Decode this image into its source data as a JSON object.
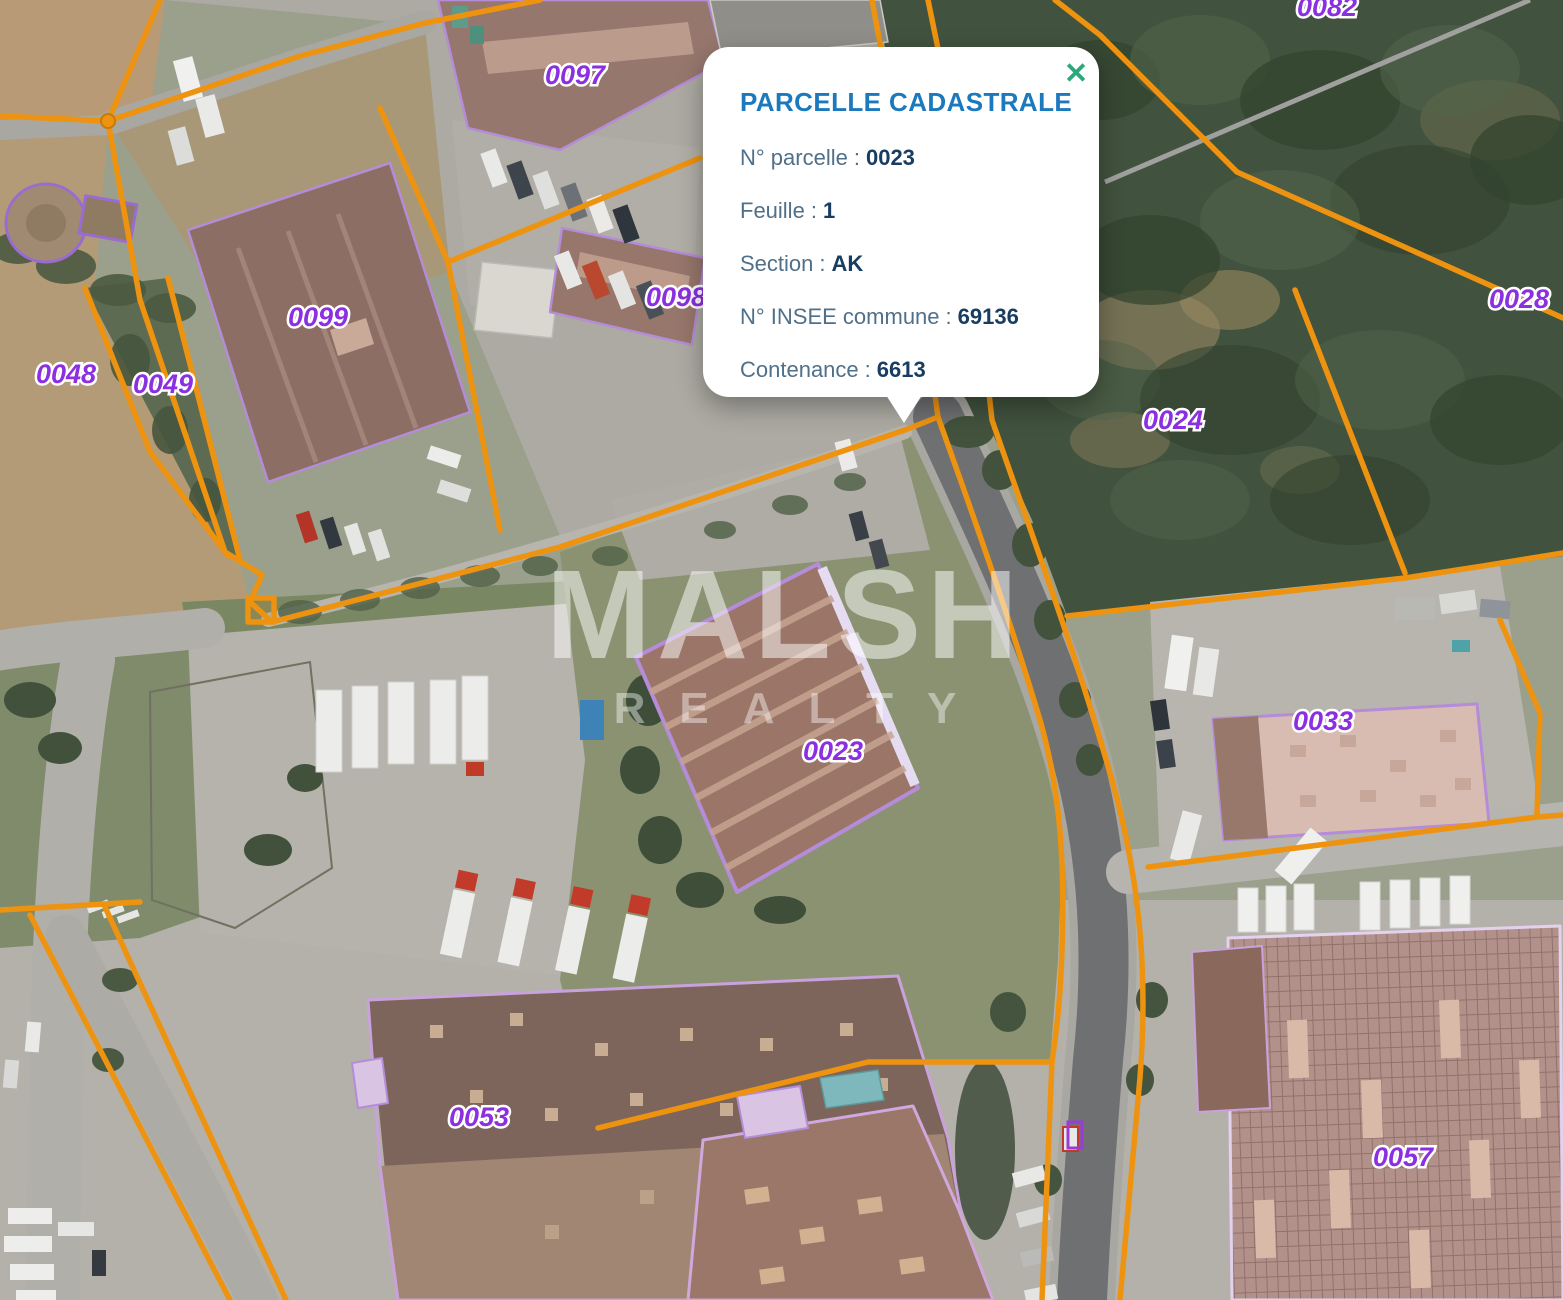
{
  "popup": {
    "title": "PARCELLE CADASTRALE",
    "separator": ":",
    "close_icon": "✕",
    "fields": [
      {
        "label": "N° parcelle",
        "value": "0023"
      },
      {
        "label": "Feuille",
        "value": "1"
      },
      {
        "label": "Section",
        "value": "AK"
      },
      {
        "label": "N° INSEE commune",
        "value": "69136"
      },
      {
        "label": "Contenance",
        "value": "6613"
      }
    ]
  },
  "watermark": {
    "line1": "MALSH",
    "line2": "REALTY"
  },
  "map": {
    "selected_parcel": "0023",
    "parcels": [
      {
        "id": "0082"
      },
      {
        "id": "0097"
      },
      {
        "id": "0098"
      },
      {
        "id": "0099"
      },
      {
        "id": "0048"
      },
      {
        "id": "0049"
      },
      {
        "id": "0028"
      },
      {
        "id": "0024"
      },
      {
        "id": "0023"
      },
      {
        "id": "0033"
      },
      {
        "id": "0053"
      },
      {
        "id": "0057"
      }
    ],
    "colors": {
      "boundary_orange": "#ee9310",
      "parcel_label_purple": "#8b2fe0",
      "selected_outline_purple": "#b48cd8",
      "popup_title_blue": "#1b79be",
      "close_green": "#2ba97c"
    }
  }
}
